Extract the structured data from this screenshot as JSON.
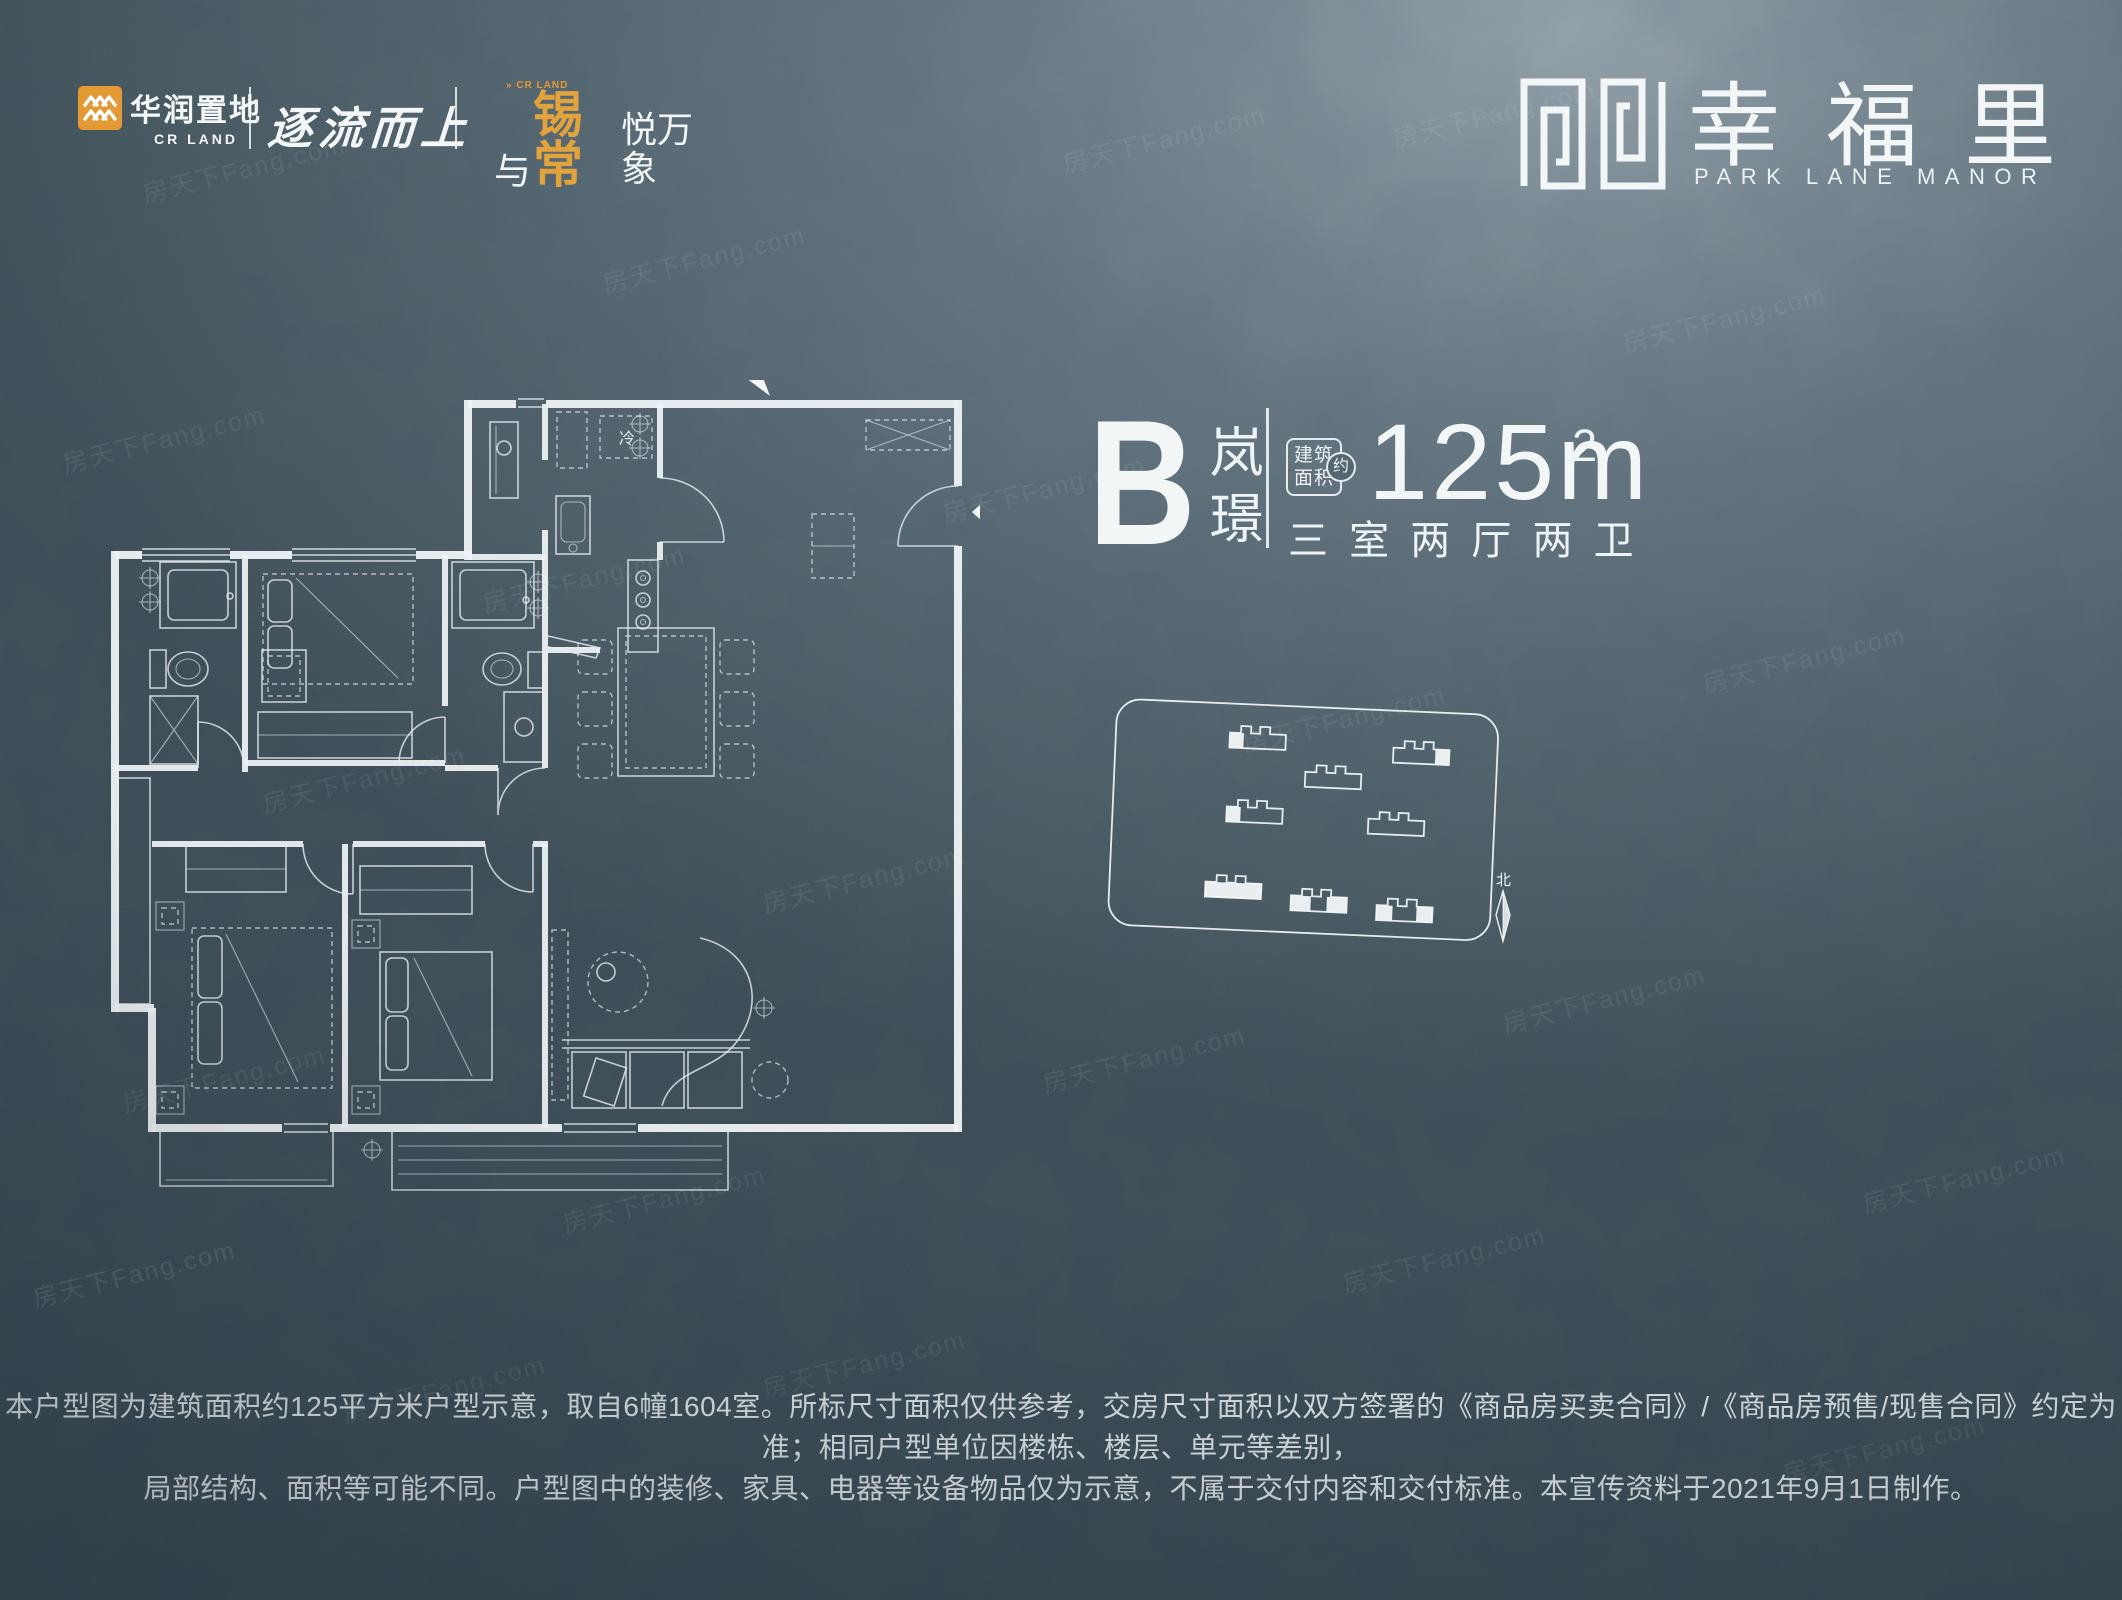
{
  "page": {
    "watermark": "房天下Fang.com"
  },
  "colors": {
    "accent_orange": "#E49A34",
    "ink_white": "#F2F6F7",
    "background_base": "#55656F"
  },
  "header": {
    "crland_logo": {
      "cn": "华润置地",
      "en": "CR LAND"
    },
    "slogan_1": "逐流而上",
    "slogan_2": {
      "tiny_top": "» CR LAND",
      "white_prefix": "与",
      "orange": "锡常",
      "white_suffix": "悦万象"
    },
    "brand": {
      "cn": "幸福里",
      "en": "PARK LANE MANOR"
    }
  },
  "unit_info": {
    "type_letter": "B",
    "type_name": "岚璟",
    "area_box_top": "建筑",
    "area_box_bottom": "面积",
    "area_approx": "约",
    "area_value": "125m",
    "area_exponent": "2",
    "layout_desc": "三 室 两 厅 两 卫"
  },
  "floor_plan": {
    "fridge_label": "冷"
  },
  "site_plan": {
    "compass_north": "北"
  },
  "disclaimer": {
    "line1": "本户型图为建筑面积约125平方米户型示意，取自6幢1604室。所标尺寸面积仅供参考，交房尺寸面积以双方签署的《商品房买卖合同》/《商品房预售/现售合同》约定为准；相同户型单位因楼栋、楼层、单元等差别，",
    "line2": "局部结构、面积等可能不同。户型图中的装修、家具、电器等设备物品仅为示意，不属于交付内容和交付标准。本宣传资料于2021年9月1日制作。"
  }
}
